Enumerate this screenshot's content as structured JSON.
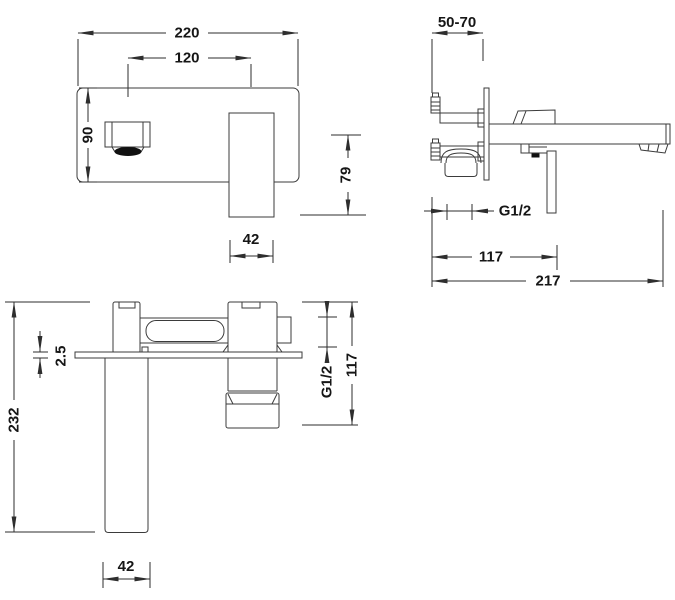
{
  "colors": {
    "line": "#3b3b3b",
    "dimension_line": "#2e2e2e",
    "text": "#161616",
    "aerator_fill": "#111111",
    "background": "#ffffff"
  },
  "views": {
    "front": {
      "dims": {
        "plate_width": "220",
        "spout_to_handle": "120",
        "plate_height": "90",
        "handle_width": "42"
      }
    },
    "side": {
      "dims": {
        "wall_depth_range": "50-70",
        "handle_drop": "79",
        "thread": "G1/2",
        "body_to_handle": "117",
        "spout_reach": "217"
      }
    },
    "plan": {
      "dims": {
        "plate_thickness": "2.5",
        "overall_length": "232",
        "thread": "G1/2",
        "body_to_handle_end": "117",
        "spout_width": "42"
      }
    }
  }
}
